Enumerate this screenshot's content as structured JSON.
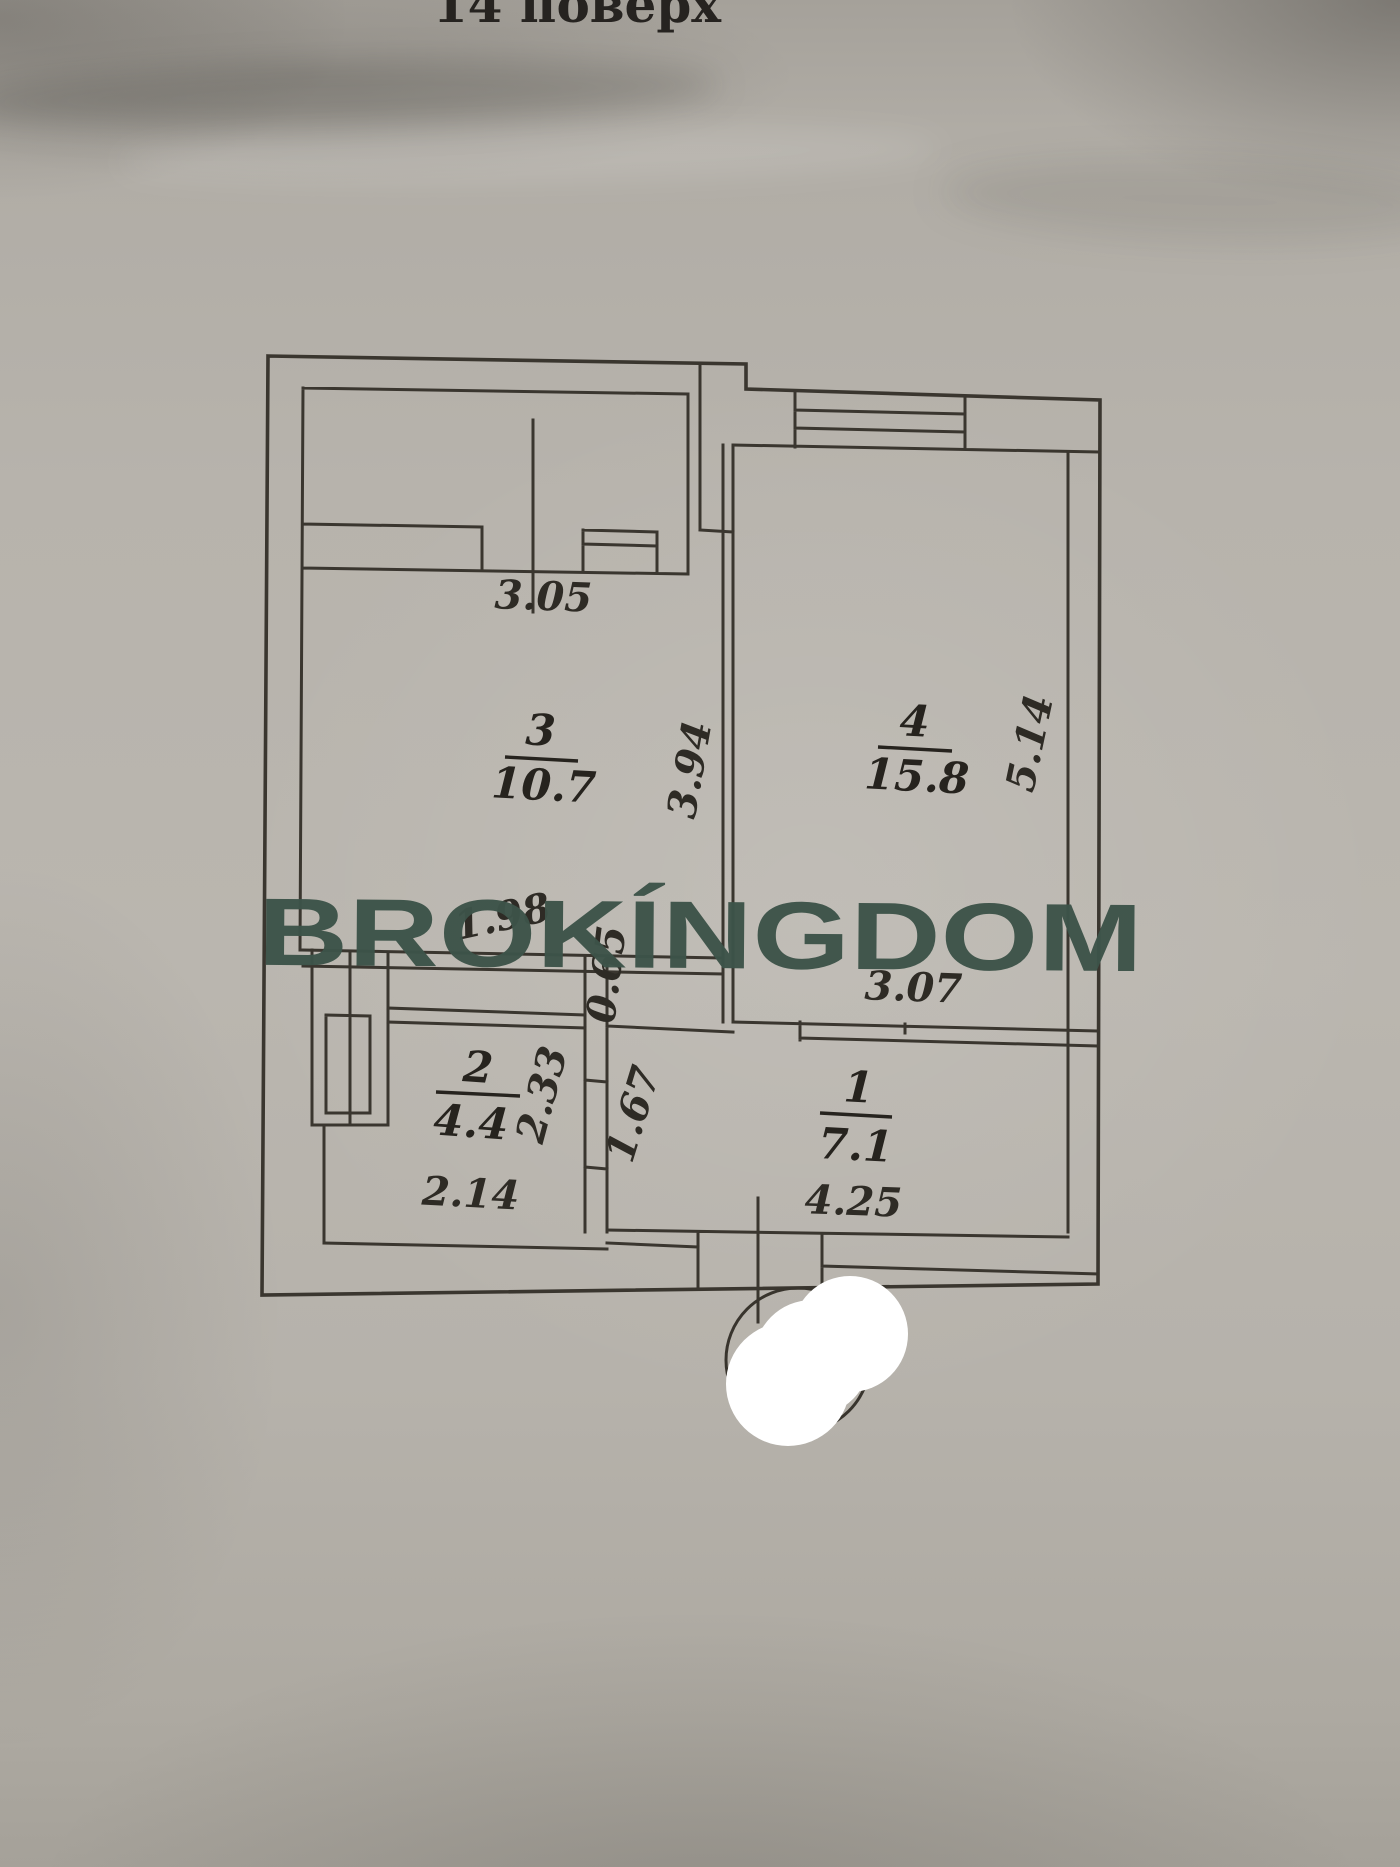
{
  "header": {
    "floor_label": "14 поверх"
  },
  "watermark": {
    "text": "BROKÍNGDOM",
    "color": "#3d5349"
  },
  "paper": {
    "background_color": "#b7b3ac",
    "ink_color": "#3a362f"
  },
  "rooms": [
    {
      "number": "3",
      "area": "10.7"
    },
    {
      "number": "4",
      "area": "15.8"
    },
    {
      "number": "2",
      "area": "4.4"
    },
    {
      "number": "1",
      "area": "7.1"
    }
  ],
  "dimensions": {
    "balcony_width": "3.05",
    "room3_depth": "3.94",
    "room4_depth": "5.14",
    "room4_width": "3.07",
    "room3_bottom_width": "1.98",
    "wall_segment": "0.65",
    "room2_height": "2.33",
    "hall_depth": "1.67",
    "room2_width": "2.14",
    "hall_width": "4.25"
  }
}
